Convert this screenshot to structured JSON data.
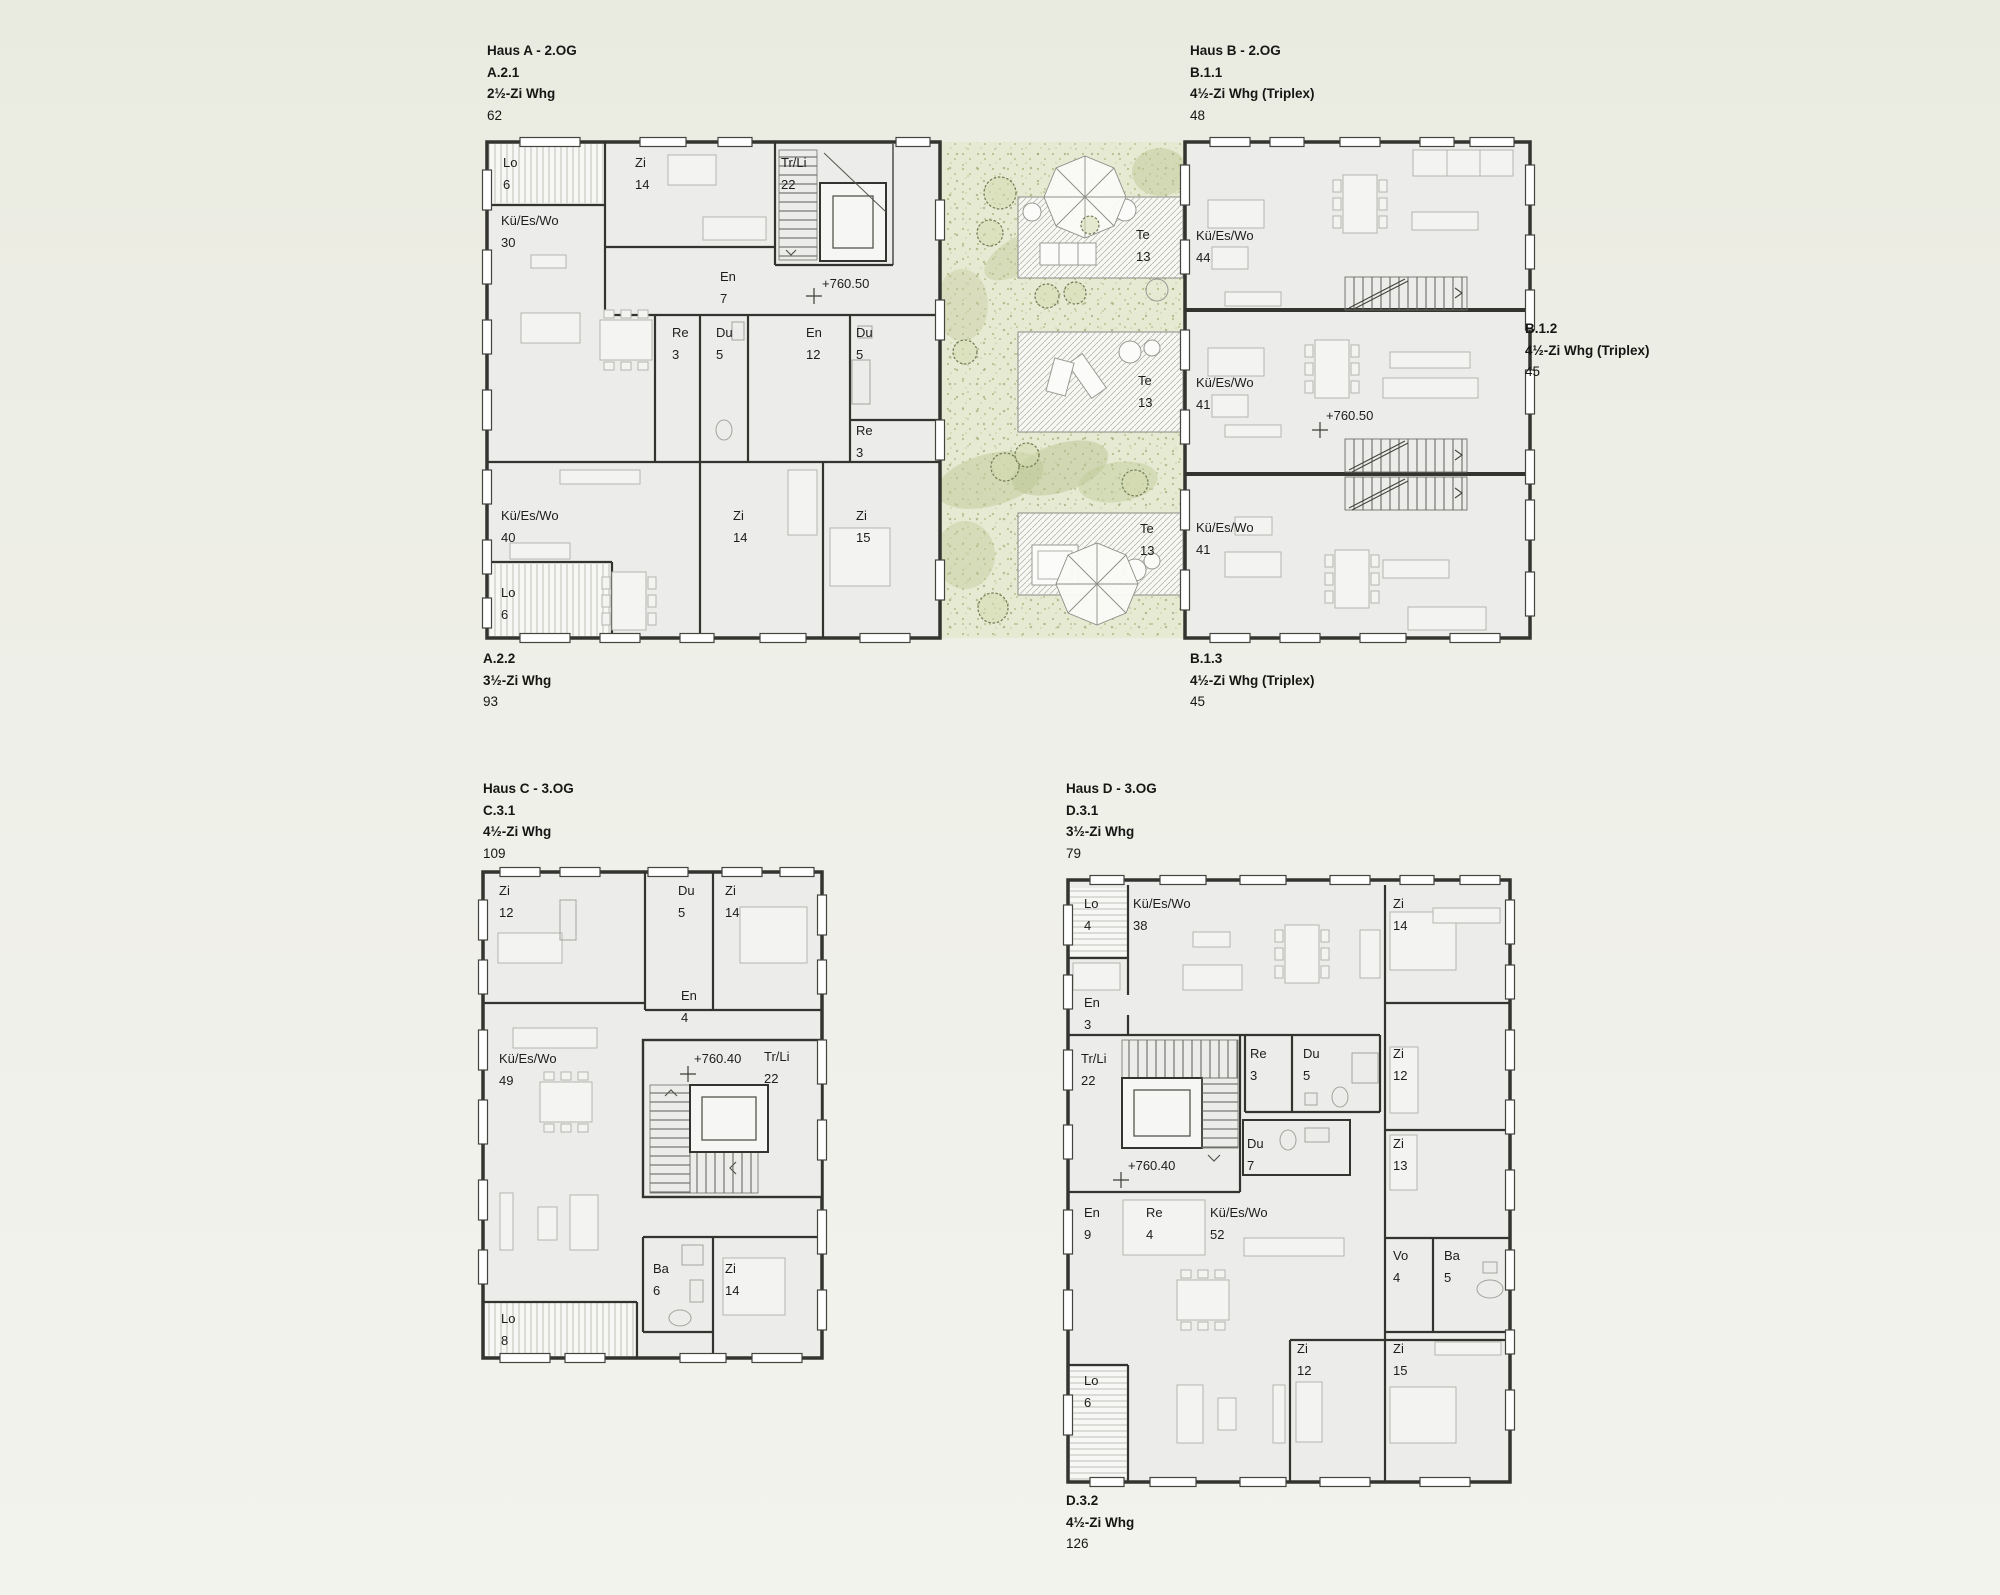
{
  "haus_a": {
    "header": [
      "Haus A - 2.OG",
      "A.2.1",
      "2½-Zi Whg",
      "62"
    ],
    "footer": [
      "A.2.2",
      "3½-Zi Whg",
      "93"
    ],
    "elevation": "+760.50",
    "rooms": [
      {
        "n": "Lo",
        "v": "6"
      },
      {
        "n": "Zi",
        "v": "14"
      },
      {
        "n": "Tr/Li",
        "v": "22"
      },
      {
        "n": "Kü/Es/Wo",
        "v": "30"
      },
      {
        "n": "En",
        "v": "7"
      },
      {
        "n": "Re",
        "v": "3"
      },
      {
        "n": "Du",
        "v": "5"
      },
      {
        "n": "En",
        "v": "12"
      },
      {
        "n": "Du",
        "v": "5"
      },
      {
        "n": "Re",
        "v": "3"
      },
      {
        "n": "Kü/Es/Wo",
        "v": "40"
      },
      {
        "n": "Zi",
        "v": "14"
      },
      {
        "n": "Zi",
        "v": "15"
      },
      {
        "n": "Lo",
        "v": "6"
      }
    ]
  },
  "haus_b": {
    "header": [
      "Haus B - 2.OG",
      "B.1.1",
      "4½-Zi Whg (Triplex)",
      "48"
    ],
    "side": [
      "B.1.2",
      "4½-Zi Whg (Triplex)",
      "45"
    ],
    "footer": [
      "B.1.3",
      "4½-Zi Whg (Triplex)",
      "45"
    ],
    "elevation": "+760.50",
    "rooms": [
      {
        "n": "Kü/Es/Wo",
        "v": "44"
      },
      {
        "n": "Kü/Es/Wo",
        "v": "41"
      },
      {
        "n": "Kü/Es/Wo",
        "v": "41"
      }
    ]
  },
  "courtyard": {
    "terraces": [
      {
        "n": "Te",
        "v": "13"
      },
      {
        "n": "Te",
        "v": "13"
      },
      {
        "n": "Te",
        "v": "13"
      }
    ]
  },
  "haus_c": {
    "header": [
      "Haus C - 3.OG",
      "C.3.1",
      "4½-Zi Whg",
      "109"
    ],
    "elevation": "+760.40",
    "rooms": [
      {
        "n": "Zi",
        "v": "12"
      },
      {
        "n": "Du",
        "v": "5"
      },
      {
        "n": "Zi",
        "v": "14"
      },
      {
        "n": "En",
        "v": "4"
      },
      {
        "n": "Kü/Es/Wo",
        "v": "49"
      },
      {
        "n": "Tr/Li",
        "v": "22"
      },
      {
        "n": "Ba",
        "v": "6"
      },
      {
        "n": "Zi",
        "v": "14"
      },
      {
        "n": "Lo",
        "v": "8"
      }
    ]
  },
  "haus_d": {
    "header": [
      "Haus D - 3.OG",
      "D.3.1",
      "3½-Zi Whg",
      "79"
    ],
    "footer": [
      "D.3.2",
      "4½-Zi Whg",
      "126"
    ],
    "elevation": "+760.40",
    "rooms": [
      {
        "n": "Lo",
        "v": "4"
      },
      {
        "n": "Kü/Es/Wo",
        "v": "38"
      },
      {
        "n": "Zi",
        "v": "14"
      },
      {
        "n": "En",
        "v": "3"
      },
      {
        "n": "Tr/Li",
        "v": "22"
      },
      {
        "n": "Re",
        "v": "3"
      },
      {
        "n": "Du",
        "v": "5"
      },
      {
        "n": "Zi",
        "v": "12"
      },
      {
        "n": "Du",
        "v": "7"
      },
      {
        "n": "Zi",
        "v": "13"
      },
      {
        "n": "En",
        "v": "9"
      },
      {
        "n": "Re",
        "v": "4"
      },
      {
        "n": "Kü/Es/Wo",
        "v": "52"
      },
      {
        "n": "Vo",
        "v": "4"
      },
      {
        "n": "Ba",
        "v": "5"
      },
      {
        "n": "Zi",
        "v": "12"
      },
      {
        "n": "Zi",
        "v": "15"
      },
      {
        "n": "Lo",
        "v": "6"
      }
    ]
  }
}
